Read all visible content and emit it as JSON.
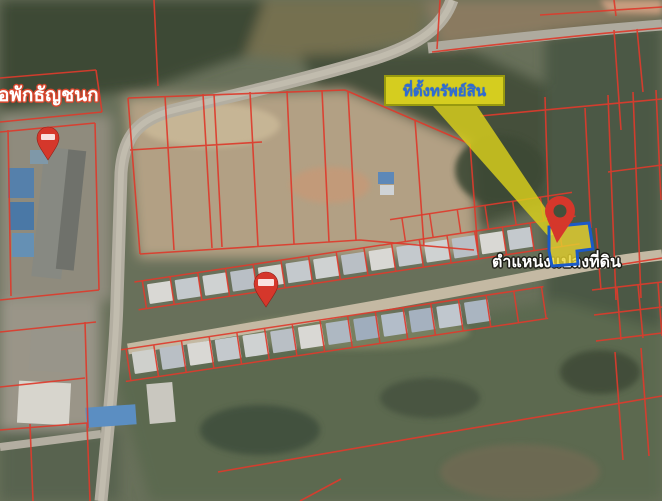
{
  "map": {
    "type": "satellite-cadastral-map",
    "labels": {
      "place_left": "อพักธัญชนก",
      "callout": "ที่ตั้งทรัพย์สิน",
      "parcel_position": "ตำแหน่งแปลงที่ดิน"
    },
    "markers": [
      {
        "id": "distance-pin-dormitory",
        "kind": "balloon-pin",
        "color": "#d5372b"
      },
      {
        "id": "distance-pin-village",
        "kind": "balloon-pin",
        "color": "#d5372b"
      },
      {
        "id": "ring-pin-property",
        "kind": "ring-pin",
        "color": "#d5372b"
      }
    ],
    "highlight": {
      "arrow_color": "#dbd11c",
      "parcel_fill": "#e8d430",
      "parcel_outline": "#1b59c7"
    },
    "colors": {
      "cadastral_line": "#dd3b2c",
      "callout_bg": "#d5cd1f",
      "callout_text": "#2e6cd6",
      "place_label_outline": "#d8472e",
      "road": "#b3aea1"
    }
  }
}
